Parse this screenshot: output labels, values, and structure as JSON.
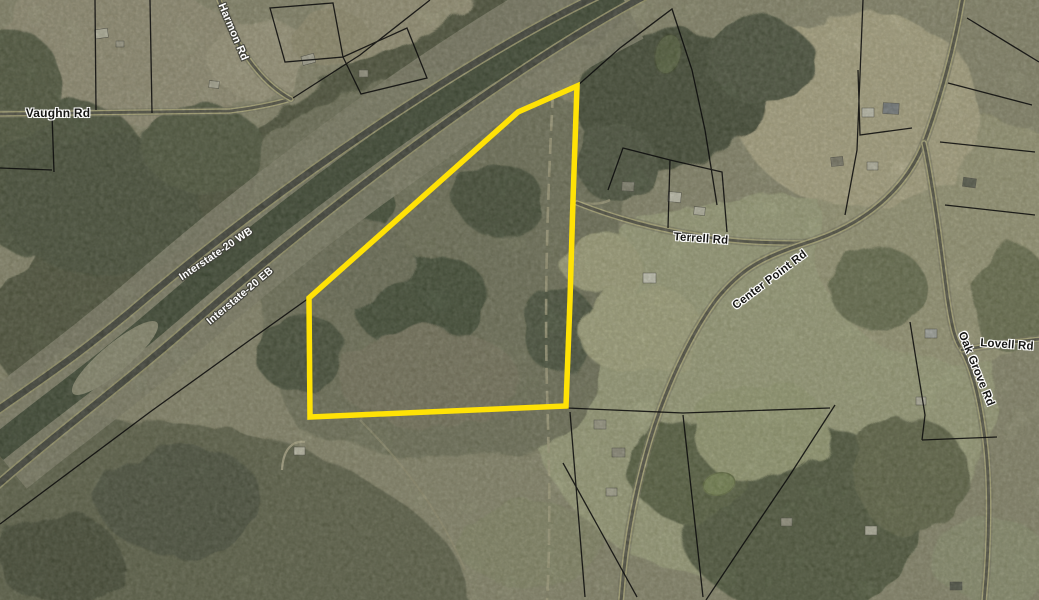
{
  "map": {
    "type": "aerial-parcel-map",
    "highlight_color": "#ffe206",
    "parcel_line_color": "#0d0d0d",
    "highlighted_parcel_outline_points": "577,86 573,200 570,300 566,406 310,417 309,298 518,112",
    "labels": [
      {
        "id": "vaughn-rd",
        "text": "Vaughn Rd",
        "x": 58,
        "y": 113,
        "rotation": 0,
        "style": "dark",
        "size": 12
      },
      {
        "id": "harmon-rd",
        "text": "Harmon Rd",
        "x": 233,
        "y": 32,
        "rotation": 67,
        "style": "light",
        "size": 11
      },
      {
        "id": "interstate-20-wb",
        "text": "Interstate-20 WB",
        "x": 216,
        "y": 254,
        "rotation": -34,
        "style": "light",
        "size": 10.5
      },
      {
        "id": "interstate-20-eb",
        "text": "Interstate-20 EB",
        "x": 240,
        "y": 296,
        "rotation": -40,
        "style": "light",
        "size": 10.5
      },
      {
        "id": "terrell-rd",
        "text": "Terrell Rd",
        "x": 701,
        "y": 239,
        "rotation": 4,
        "style": "dark",
        "size": 11.5
      },
      {
        "id": "center-point-rd",
        "text": "Center Point Rd",
        "x": 770,
        "y": 280,
        "rotation": -37,
        "style": "dark",
        "size": 11.5
      },
      {
        "id": "lovell-rd",
        "text": "Lovell Rd",
        "x": 1007,
        "y": 345,
        "rotation": 4,
        "style": "dark",
        "size": 11.5
      },
      {
        "id": "oak-grove-rd",
        "text": "Oak Grove Rd",
        "x": 976,
        "y": 369,
        "rotation": 68,
        "style": "dark",
        "size": 11.5
      }
    ]
  }
}
